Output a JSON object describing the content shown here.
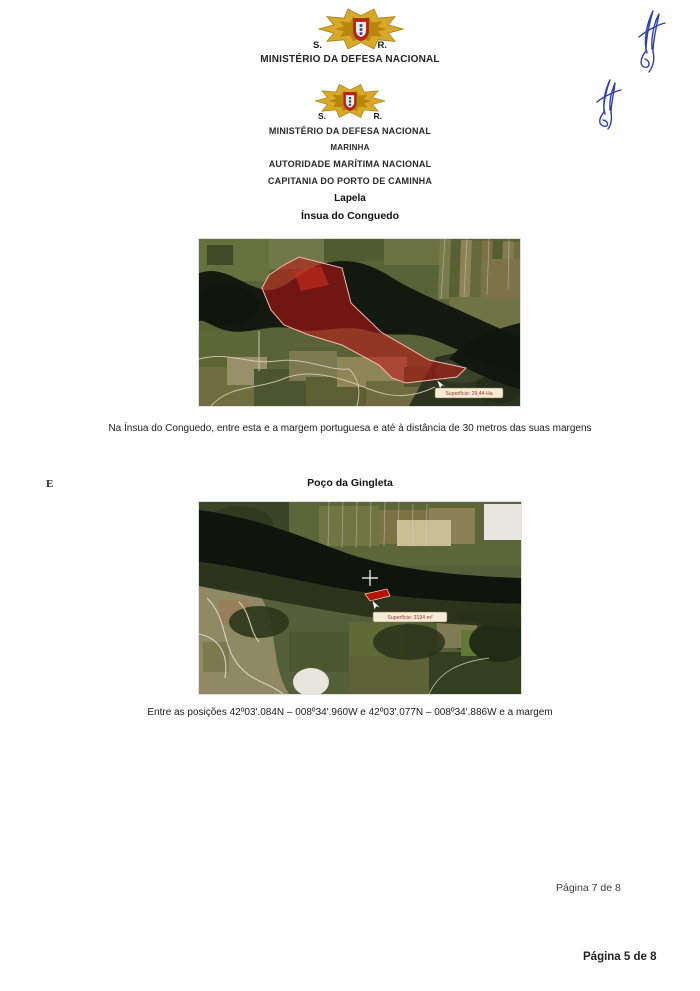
{
  "header_top": {
    "left_initial": "S.",
    "right_initial": "R.",
    "ministry": "MINISTÉRIO DA DEFESA NACIONAL"
  },
  "header": {
    "left_initial": "S.",
    "right_initial": "R.",
    "lines": [
      "MINISTÉRIO DA DEFESA NACIONAL",
      "MARINHA",
      "AUTORIDADE MARÍTIMA NACIONAL",
      "CAPITANIA DO PORTO DE CAMINHA"
    ]
  },
  "section_insua": {
    "place": "Lapela",
    "title": "Ínsua do Conguedo",
    "map_area_label": "Superfície: 29,44 Ha",
    "caption": "Na Ínsua do Conguedo, entre esta e a margem portuguesa e até à distância de 30 metros das suas margens"
  },
  "stray_mark": "E",
  "section_gingleta": {
    "title": "Poço da Gingleta",
    "map_area_label": "Superfície: 3194 m²",
    "caption": "Entre as posições 42º03'.084N – 008º34'.960W e 42º03'.077N – 008º34'.886W e a margem"
  },
  "footers": {
    "page_note_upper": "Página 7 de 8",
    "page_note_lower": "Página 5 de 8"
  },
  "colors": {
    "overlay_red": "#c01414",
    "label_background": "#f5ecd8",
    "signature_blue": "#2f3fae",
    "emblem_gold": "#d8a828"
  }
}
